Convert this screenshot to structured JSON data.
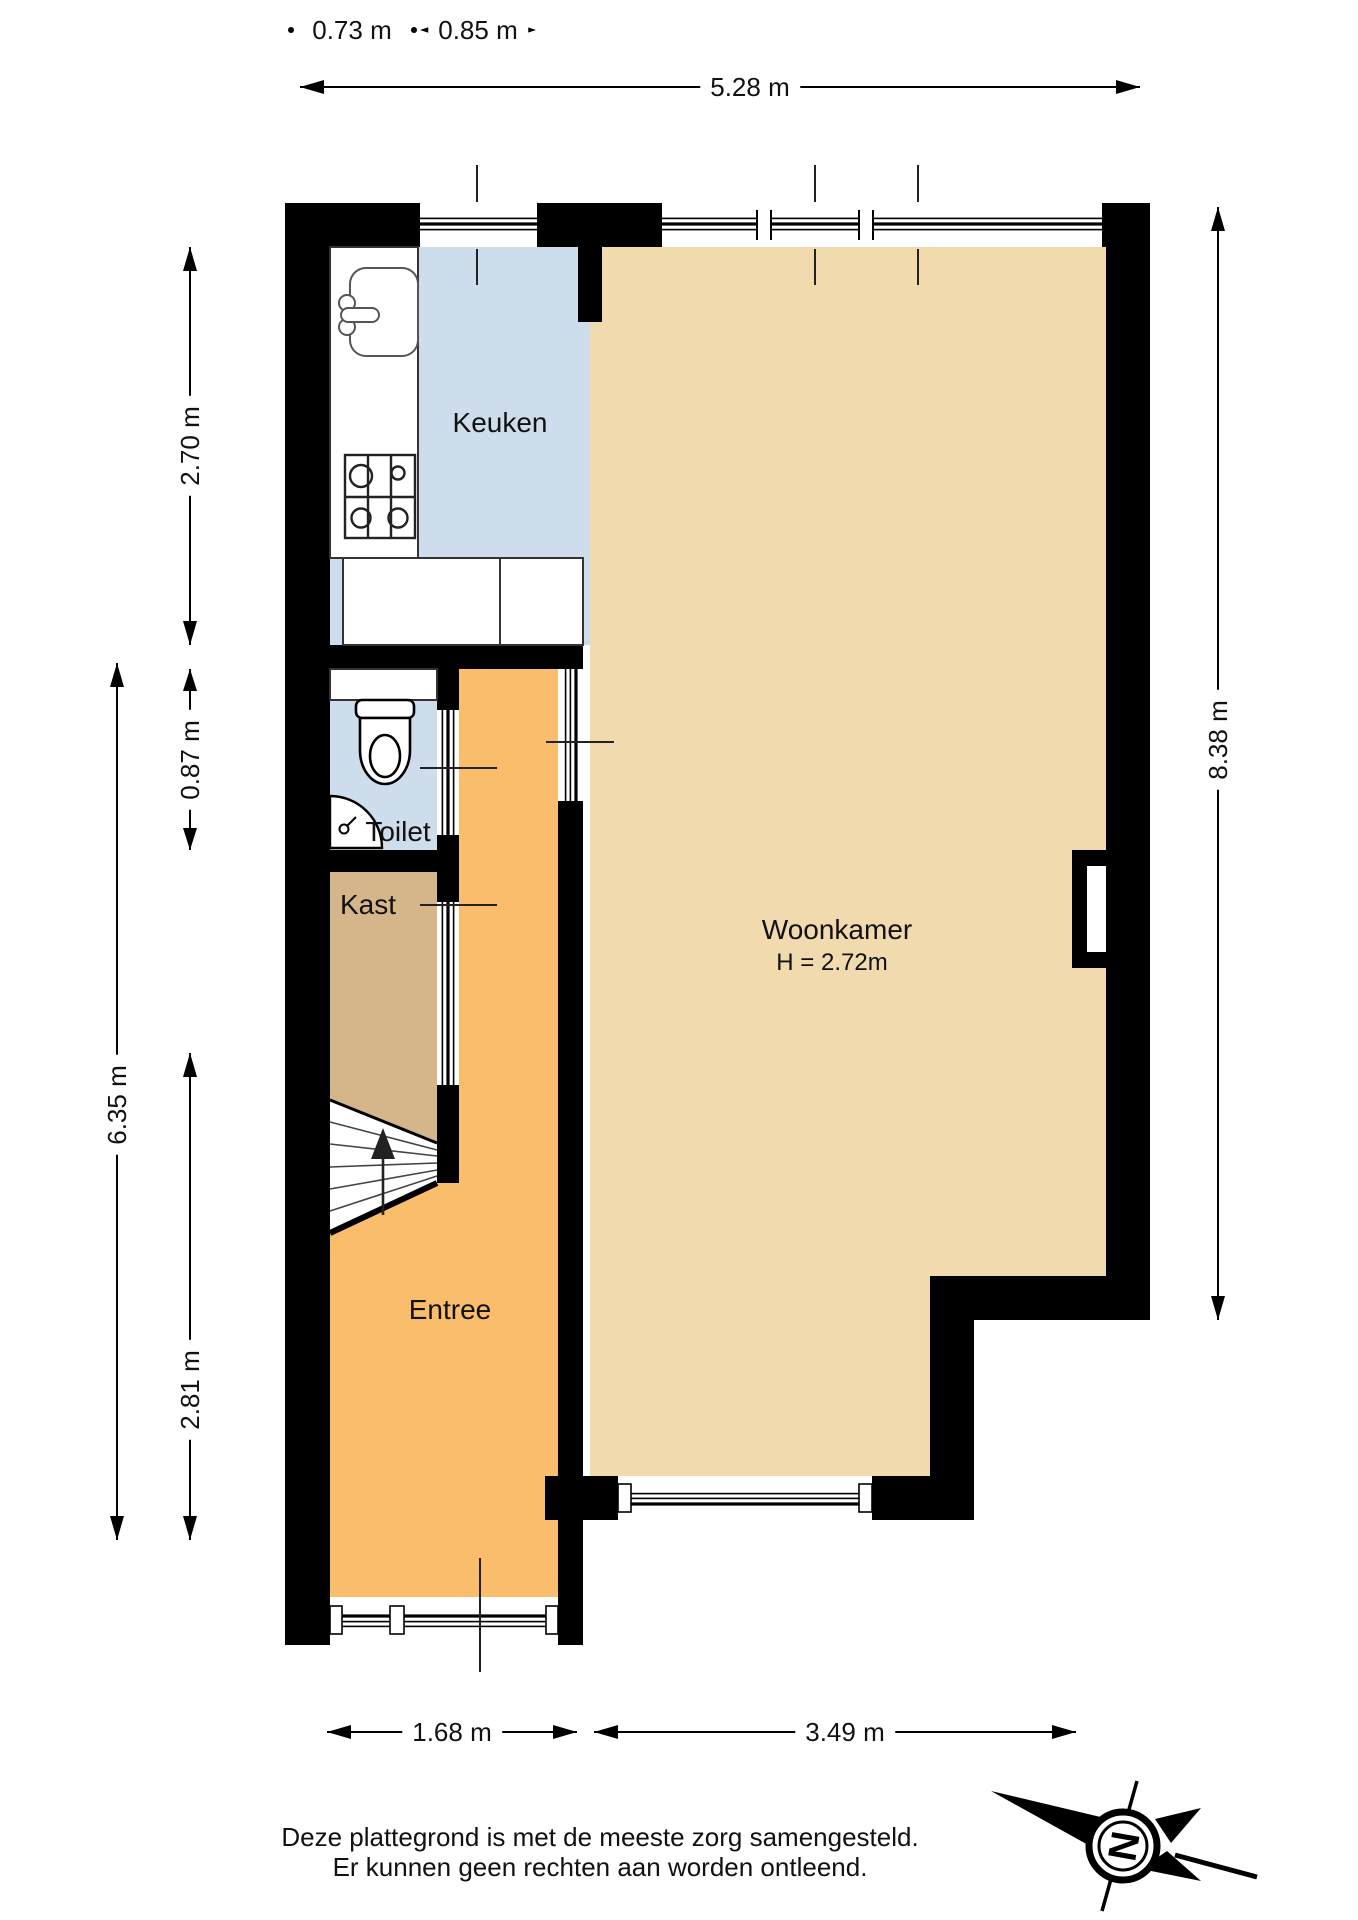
{
  "rooms": {
    "keuken": "Keuken",
    "toilet": "Toilet",
    "kast": "Kast",
    "woonkamer": "Woonkamer",
    "woonkamer_height": "H = 2.72m",
    "entree": "Entree"
  },
  "dimensions": {
    "top_left_small": "0.73 m",
    "top_window": "0.85 m",
    "top_total": "5.28 m",
    "keuken_depth": "2.70 m",
    "toilet_depth": "0.87 m",
    "left_lower_total": "6.35 m",
    "entree_depth": "2.81 m",
    "right_total": "8.38 m",
    "entree_width": "1.68 m",
    "woonkamer_width": "3.49 m"
  },
  "compass": {
    "north_letter": "N"
  },
  "footer": {
    "line1": "Deze plattegrond is met de meeste zorg samengesteld.",
    "line2": "Er kunnen geen rechten aan worden ontleend."
  },
  "colors": {
    "wall": "#000000",
    "keuken_floor": "#CEDDEC",
    "toilet_floor": "#CEDDEC",
    "woonkamer_floor": "#F2DAAF",
    "kast_floor": "#D5B58A",
    "entree_floor": "#F9BD6C"
  },
  "icons": {
    "sink": "sink-icon",
    "stove": "stove-icon",
    "toilet_bowl": "toilet-icon",
    "corner_sink": "corner-sink-icon",
    "stairs_arrow": "stairs-up-arrow-icon",
    "compass": "north-arrow-icon"
  }
}
